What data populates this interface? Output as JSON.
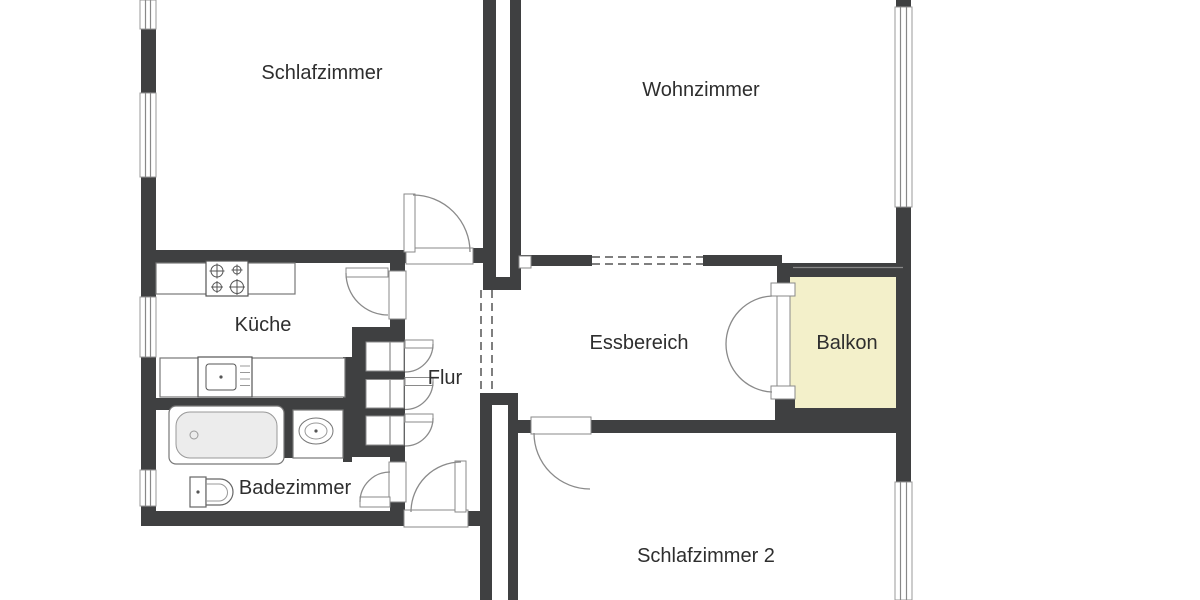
{
  "plan": {
    "type": "apartment-floor-plan",
    "rooms": [
      {
        "id": "schlafzimmer",
        "label": "Schlafzimmer"
      },
      {
        "id": "wohnzimmer",
        "label": "Wohnzimmer"
      },
      {
        "id": "kueche",
        "label": "Küche"
      },
      {
        "id": "flur",
        "label": "Flur"
      },
      {
        "id": "essbereich",
        "label": "Essbereich"
      },
      {
        "id": "balkon",
        "label": "Balkon"
      },
      {
        "id": "badezimmer",
        "label": "Badezimmer"
      },
      {
        "id": "schlafzimmer2",
        "label": "Schlafzimmer 2"
      }
    ],
    "fixtures": [
      "stove-icon",
      "kitchen-sink-icon",
      "bathtub-icon",
      "washbasin-icon",
      "toilet-icon",
      "door-swing-icon",
      "window-icon",
      "wardrobe-niche-icon"
    ],
    "colors": {
      "wall": "#3f4041",
      "balcony_fill": "#f3f0ca",
      "fixture_line": "#8a8a8a",
      "dashed_opening": "#555555",
      "text": "#2e2e2e",
      "background": "#ffffff"
    }
  }
}
